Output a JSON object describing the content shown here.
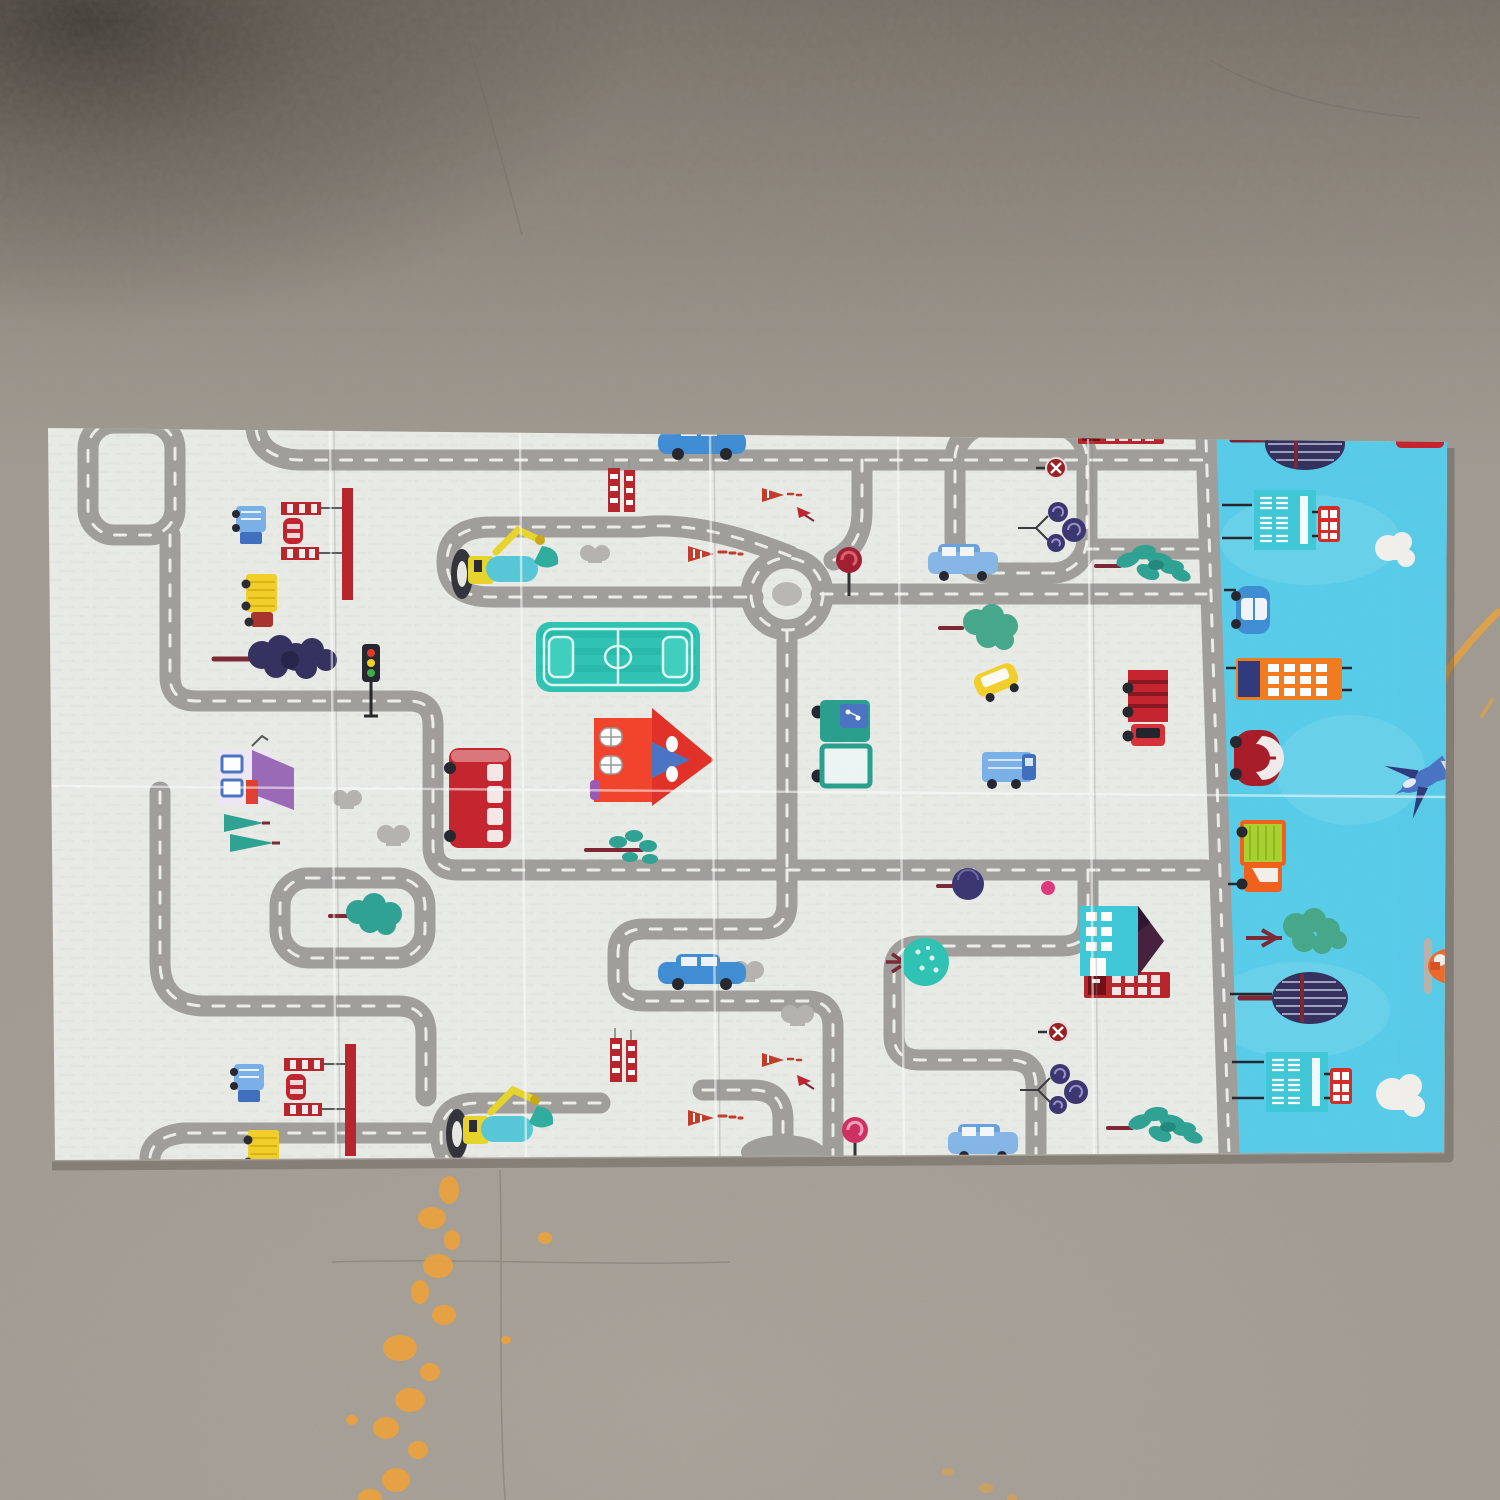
{
  "scene": {
    "type": "photograph",
    "subject": "foldable children's play mat with road-map print lying on a concrete floor",
    "floor": "gray speckled concrete with orange paint smears and faint cracks",
    "mat_layout": "large cream area with gray toy roads, vehicles, houses and trees; cyan sky-city strip along the right edge; fold creases across panels"
  },
  "colors": {
    "floor": "#a39d94",
    "floor_top": "#8a8177",
    "floor_corner": "#4b453e",
    "paint": "#eca23b",
    "crack": "#6f6960",
    "mat_white": "#eaece7",
    "mat_sky": "#58cdea",
    "road": "#a09f9b",
    "road_dash": "#f2f3ee",
    "road_center": "#b9b8b4",
    "field": "#2fc4b4",
    "cloud": "#f3f1ec",
    "bus_red": "#c6242e",
    "house_red": "#f4432c",
    "roof_purple": "#9b6ab8",
    "truck_yellow": "#f3d02a",
    "car_blue": "#3f8ed6",
    "wagon_blue": "#85b7e8",
    "truck_lightblue": "#7ab0ea",
    "pickup_teal": "#2aa08e",
    "fence_red": "#b8252c",
    "cone_red": "#c23b2a",
    "sign_red": "#9c1f24",
    "tree_navy": "#34315f",
    "tree_teal": "#2fa394",
    "tree_green": "#45a98a",
    "trunk": "#7c2736",
    "swirl_purple": "#3b3671",
    "sky_building": "#3fc9d9",
    "skyscraper_orange": "#f27c1e",
    "beetle_red": "#a81c28",
    "jet_blue": "#4a74c4",
    "truck_orange": "#f2611c",
    "cargo_green": "#aad22e",
    "heli_orange": "#f06a2a",
    "lollipop_dark": "#a31e32",
    "lollipop_pink": "#cf2f62",
    "pink_dot": "#e0387e",
    "bump_gray": "#b5b4b0",
    "excavator_yellow": "#e8d52b",
    "excavator_teal": "#57c8d8"
  },
  "inventory": {
    "mat_items": [
      "roads with white dashed centerlines",
      "roundabout",
      "soccer field",
      "red double-decker bus",
      "orange-red house",
      "purple-roof house",
      "teal-maroon house",
      "red phone-booth buildings",
      "excavators",
      "yellow dump trucks",
      "blue trucks",
      "red fence barriers with mini car",
      "striped traffic cones",
      "traffic light",
      "no-entry signs",
      "lollipop signs",
      "swirl trees",
      "pine trees",
      "navy lumpy trees",
      "blue sedans",
      "blue station wagons",
      "yellow car",
      "red truck",
      "green pickup truck",
      "gray bushes",
      "half roundabout at bottom edge"
    ],
    "sky_strip_items": [
      "striped navy trees",
      "teal buildings with red mini buses",
      "clouds",
      "blue car",
      "orange skyscraper",
      "red beetle car",
      "blue fighter jet",
      "orange truck with green cargo",
      "green tree",
      "orange helicopter"
    ],
    "floor_items": [
      "orange paint smears bottom-left",
      "orange streak right edge",
      "hairline cracks",
      "dark shadow top-left corner"
    ]
  }
}
